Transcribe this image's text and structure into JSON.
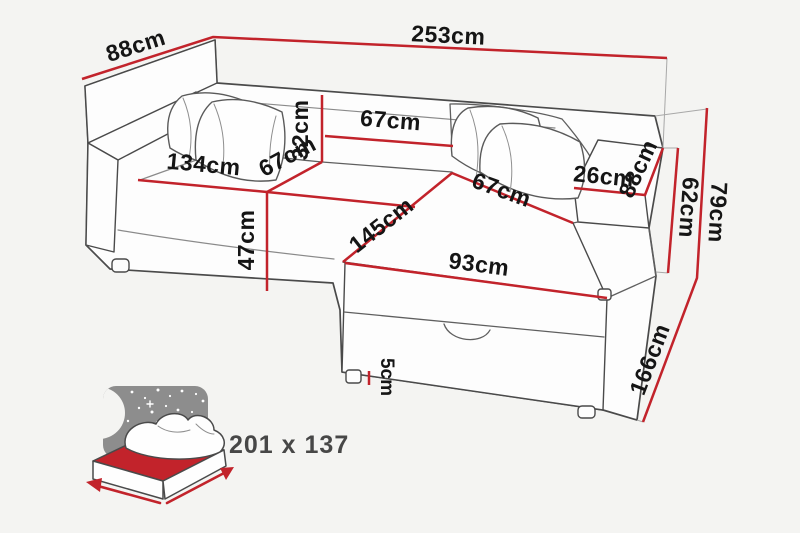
{
  "diagram": {
    "type": "corner-sofa-dimension-diagram",
    "unit": "cm",
    "labels": {
      "total_width": "253cm",
      "total_depth": "88cm",
      "total_height": "79cm",
      "backrest_width": "67cm",
      "backrest_height": "32cm",
      "left_seat_width": "134cm",
      "seat_depth": "67cm",
      "right_seat_width": "67cm",
      "seat_height": "47cm",
      "chaise_diagonal": "145cm",
      "chaise_width": "93cm",
      "chaise_length": "166cm",
      "armrest_width": "26cm",
      "armrest_depth": "88cm",
      "armrest_height": "62cm",
      "leg_height": "5cm",
      "sleeping_area": "201 x 137"
    },
    "colors": {
      "dimension_line": "#c2232b",
      "sofa_outline": "#4a4a4a",
      "background": "#f4f4f2",
      "icon_gray": "#8d8d8d",
      "mattress_red": "#c2232b",
      "label_text": "#151515"
    }
  }
}
